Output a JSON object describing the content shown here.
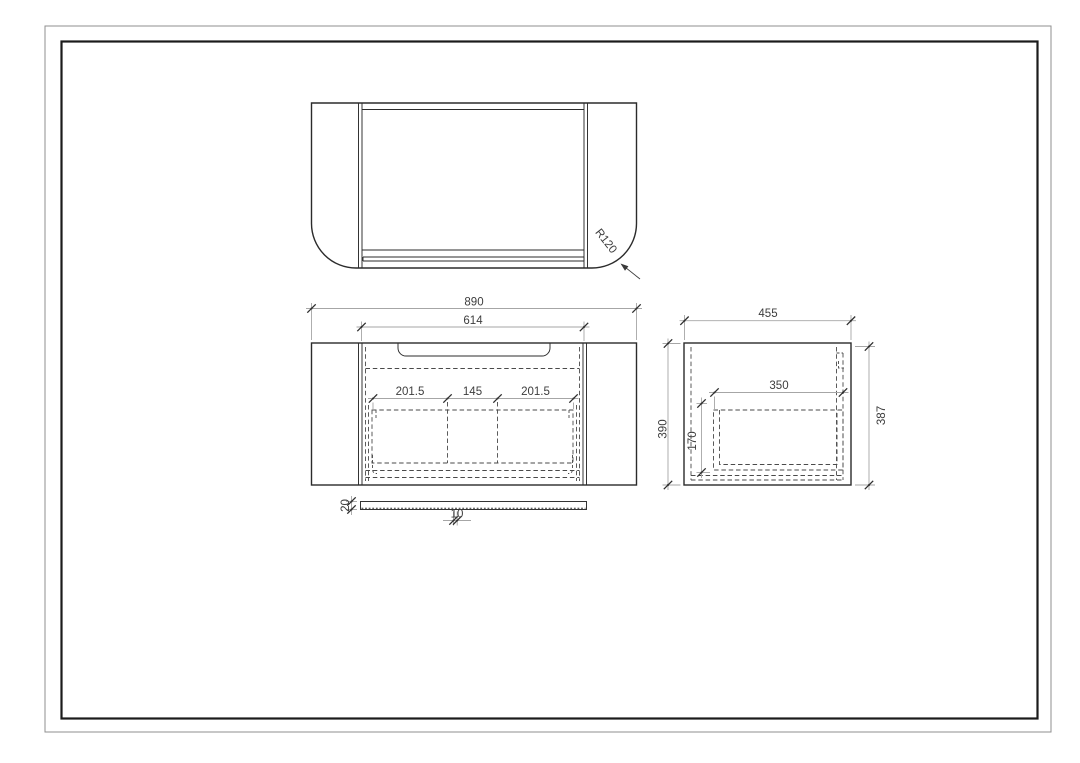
{
  "page": {
    "background_color": "#ffffff",
    "border_outer_color": "#8f8f8f",
    "border_inner_color": "#1b1b1b"
  },
  "drawing": {
    "outline_color": "#2b2b2b",
    "dashed_color": "#4a4a4a",
    "dim_line_color": "#a6a6a6",
    "dim_text_color": "#3d3d3d",
    "views": {
      "top_view": {
        "corner_radius_label": "R120"
      },
      "front_view": {
        "overall_width": "890",
        "inner_width": "614",
        "segment_left": "201.5",
        "segment_center": "145",
        "segment_right": "201.5"
      },
      "side_view": {
        "depth": "455",
        "height_left": "390",
        "height_right": "387",
        "drawer_depth": "350",
        "drawer_height": "170"
      },
      "trim_strip": {
        "thickness": "20",
        "offset": "10"
      }
    }
  }
}
